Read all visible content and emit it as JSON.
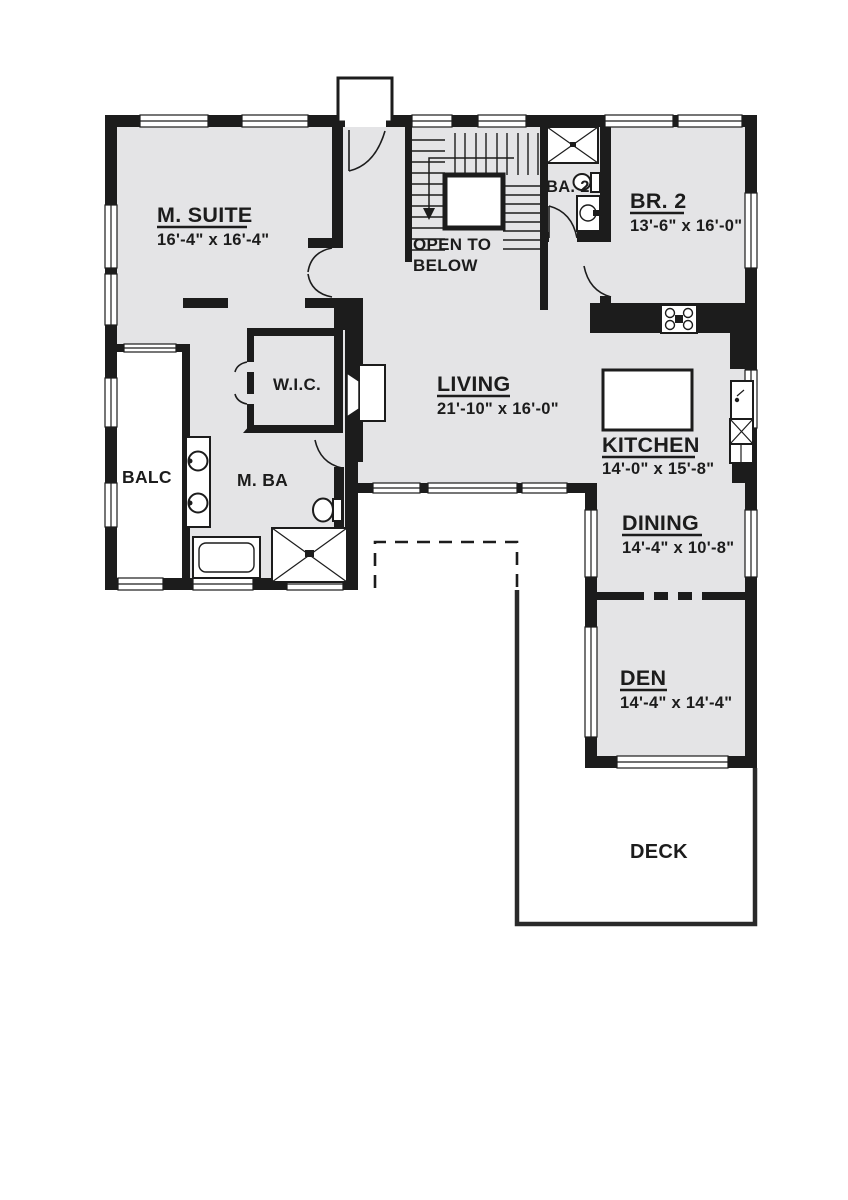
{
  "plan_type": "floor-plan",
  "rooms": [
    {
      "name": "M. SUITE",
      "dims": "16'-4\" x 16'-4\""
    },
    {
      "name": "BR. 2",
      "dims": "13'-6\" x 16'-0\""
    },
    {
      "name": "LIVING",
      "dims": "21'-10\" x 16'-0\""
    },
    {
      "name": "KITCHEN",
      "dims": "14'-0\" x 15'-8\""
    },
    {
      "name": "DINING",
      "dims": "14'-4\" x 10'-8\""
    },
    {
      "name": "DEN",
      "dims": "14'-4\" x 14'-4\""
    }
  ],
  "labels": {
    "open_to_below_line1": "OPEN TO",
    "open_to_below_line2": "BELOW",
    "ba2": "BA. 2",
    "wic": "W.I.C.",
    "mba": "M. BA",
    "balc": "BALC",
    "deck": "DECK"
  },
  "colors": {
    "wall": "#1c1c1c",
    "room_fill": "#e4e4e6",
    "background": "#ffffff"
  }
}
